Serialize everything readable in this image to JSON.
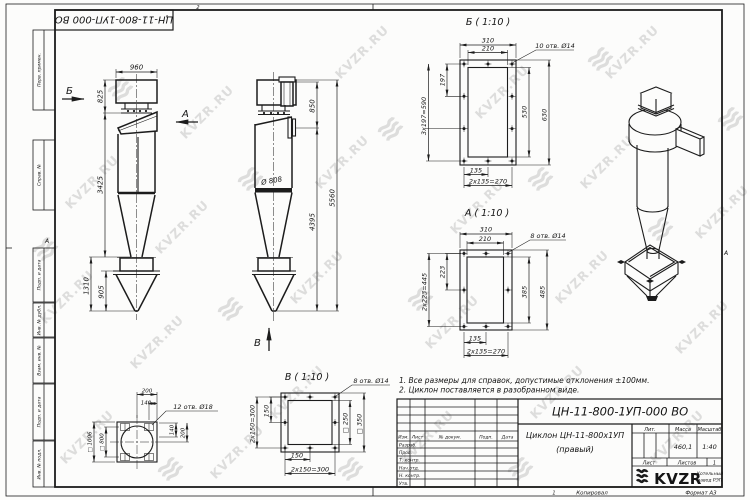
{
  "watermark": {
    "text": "KVZR.RU"
  },
  "sheet": {
    "top_stamp": "ЦН-11-800-1УП-000 ВО",
    "left_margin_fields": [
      "Перв. примен.",
      "Справ. №",
      "Подп. и дата",
      "Инв. № дубл.",
      "Взам. инв. №",
      "Подп. и дата",
      "Инв. № подл."
    ],
    "zone_marks": {
      "top": "2",
      "bottom": "1",
      "left": "А",
      "right": "А"
    },
    "footer": {
      "copied": "Копировал",
      "format": "Формат А3"
    }
  },
  "notes": {
    "line1": "1. Все размеры для справок, допустимые отклонения ±100мм.",
    "line2": "2. Циклон поставляется в разобранном виде."
  },
  "views": {
    "side": {
      "label_b": "Б",
      "label_a": "А",
      "dim_960": "960",
      "dim_825": "825",
      "dim_3425": "3425",
      "dim_1310": "1310",
      "dim_905": "905"
    },
    "front": {
      "label_v": "В",
      "dim_850": "850",
      "dim_5560": "5560",
      "dim_4395": "4395",
      "dim_d808": "Ø 808"
    },
    "section_b": {
      "title": "Б ( 1:10 )",
      "callout": "10 отв. Ø14",
      "dim_310": "310",
      "dim_210": "210",
      "dim_197": "197",
      "dim_590": "3х197=590",
      "dim_530": "530",
      "dim_630": "630",
      "dim_135": "135",
      "dim_270": "2х135=270"
    },
    "section_a": {
      "title": "А ( 1:10 )",
      "callout": "8 отв. Ø14",
      "dim_310": "310",
      "dim_210": "210",
      "dim_223": "223",
      "dim_445": "2х223=445",
      "dim_385": "385",
      "dim_485": "485",
      "dim_135": "135",
      "dim_270": "2х135=270"
    },
    "section_v": {
      "title": "В ( 1:10 )",
      "callout": "8 отв. Ø14",
      "dim_150_left": "150",
      "dim_300_left": "2х150=300",
      "dim_150_bot": "150",
      "dim_300_bot": "2х150=300",
      "dim_sq250": "□ 250",
      "dim_sq350": "□ 350"
    },
    "flange": {
      "callout": "12 отв. Ø18",
      "dim_200_top": "200",
      "dim_140_top": "140",
      "dim_140_right": "140",
      "dim_200_right": "200",
      "dim_sq1006": "□ 1006",
      "dim_sq800": "□ 800"
    }
  },
  "title_block": {
    "doc_number": "ЦН-11-800-1УП-000 ВО",
    "name_line1": "Циклон ЦН-11-800х1УП",
    "name_line2": "(правый)",
    "header_cols": [
      "Изм.",
      "Лист",
      "№ докум.",
      "Подп.",
      "Дата"
    ],
    "sig_rows": [
      "Разраб.",
      "Пров.",
      "Т. контр.",
      "Нач.отд.",
      "Н. контр.",
      "Утв."
    ],
    "lit_label": "Лит.",
    "mass_label": "Масса",
    "scale_label": "Масштаб",
    "mass_value": "460,1",
    "scale_value": "1:40",
    "sheet_label": "Лист",
    "sheets_label": "Листов",
    "sheets_value": "1",
    "logo": {
      "text": "KVZR",
      "sub1": "Котельный",
      "sub2": "завод РЭП"
    }
  }
}
